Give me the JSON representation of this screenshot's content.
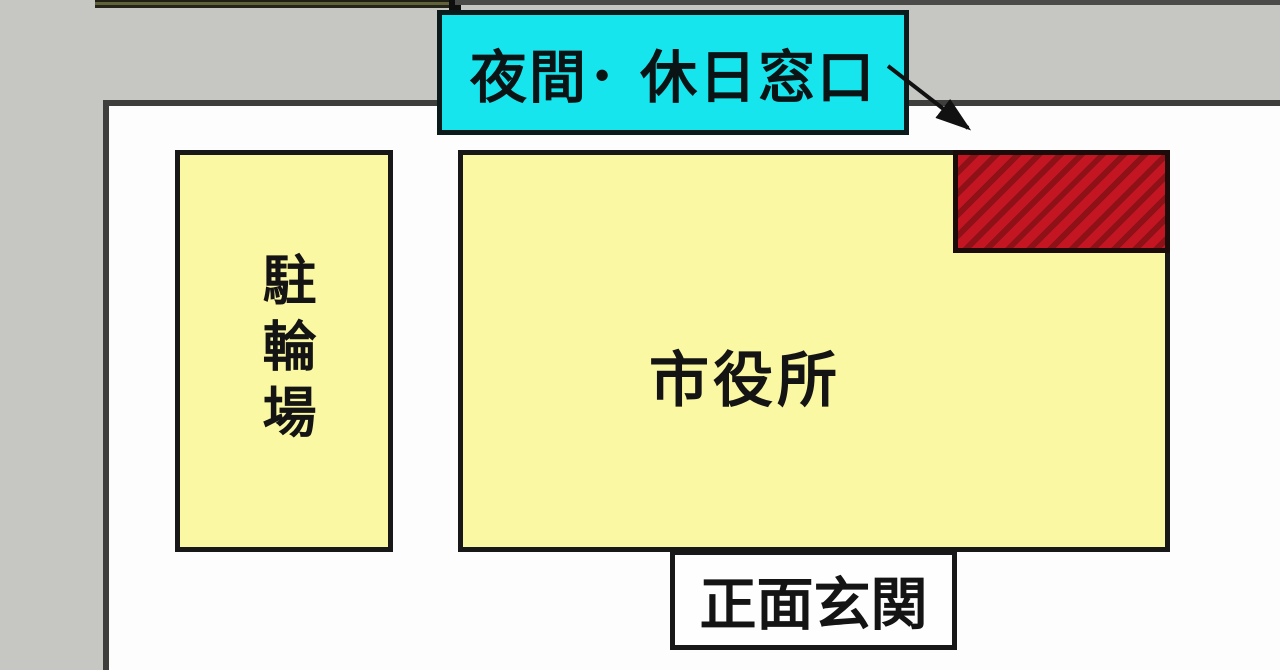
{
  "map": {
    "labels": {
      "night_holiday_window": "夜間･ 休日窓口",
      "city_hall": "市役所",
      "bicycle_parking": "駐輪場",
      "main_entrance": "正面玄関"
    }
  },
  "colors": {
    "road_gray": "#c6c6c3",
    "map_white": "#fdfdfd",
    "building_yellow": "#faf8a2",
    "highlight_cyan": "#17e5ee",
    "hatch_red": "#c41622",
    "hatch_red_dark": "#8e1118",
    "border_dark": "#3e3e3c",
    "box_border": "#181818",
    "text_dark": "#141414"
  }
}
